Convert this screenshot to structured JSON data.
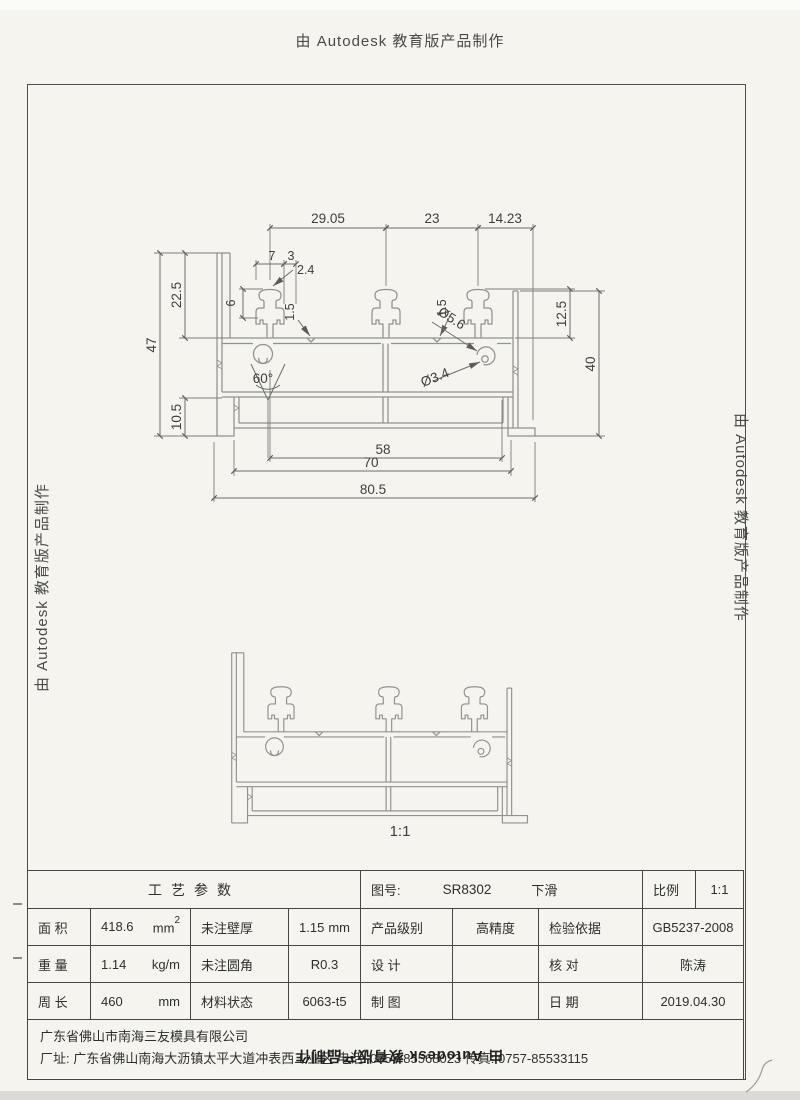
{
  "watermark": {
    "top": "由 Autodesk 教育版产品制作",
    "left": "由 Autodesk 教育版产品制作",
    "right": "由 Autodesk 教育版产品制作",
    "bottom_flipped": "由 Autodesk 教育版产品制作"
  },
  "drawing": {
    "scale_caption": "1:1",
    "dims": {
      "top_w1": "29.05",
      "top_w2": "23",
      "top_w3": "14.23",
      "hook_w1": "7",
      "hook_w2": "3",
      "slot": "2.4",
      "hook_h": "6",
      "left_h1": "22.5",
      "left_h2": "47",
      "left_h3": "10.5",
      "right_h1": "12.5",
      "right_h2": "40",
      "wall1": "1.5",
      "wall2": "1.5",
      "dia1": "Ø5.6",
      "dia2": "Ø3.4",
      "angle": "60°",
      "bot_w1": "58",
      "bot_w2": "70",
      "bot_w3": "80.5"
    }
  },
  "title_block": {
    "process_header": "工艺参数",
    "drawing_no_label": "图号:",
    "drawing_no": "SR8302",
    "drawing_name": "下滑",
    "scale_label": "比例",
    "scale_value": "1:1",
    "rows": [
      {
        "label": "面 积",
        "value": "418.6",
        "unit": "mm",
        "unit_sup": "2",
        "p_label": "未注壁厚",
        "p_value": "1.15",
        "p_unit": "mm",
        "r_label": "产品级别",
        "r_value": "高精度",
        "c_label": "检验依据",
        "c_value": "GB5237-2008"
      },
      {
        "label": "重 量",
        "value": "1.14",
        "unit": "kg/m",
        "unit_sup": "",
        "p_label": "未注圆角",
        "p_value": "R0.3",
        "p_unit": "",
        "r_label": "设 计",
        "r_value": "",
        "c_label": "核 对",
        "c_value": "陈涛"
      },
      {
        "label": "周 长",
        "value": "460",
        "unit": "mm",
        "unit_sup": "",
        "p_label": "材料状态",
        "p_value": "6063-t5",
        "p_unit": "",
        "r_label": "制 图",
        "r_value": "",
        "c_label": "日 期",
        "c_value": "2019.04.30"
      }
    ]
  },
  "company": {
    "name": "广东省佛山市南海三友模具有限公司",
    "address_line": "厂址: 广东省佛山南海大沥镇太平大道冲表西工业区  电话: 0757-85568023 传真: 0757-85533115"
  }
}
